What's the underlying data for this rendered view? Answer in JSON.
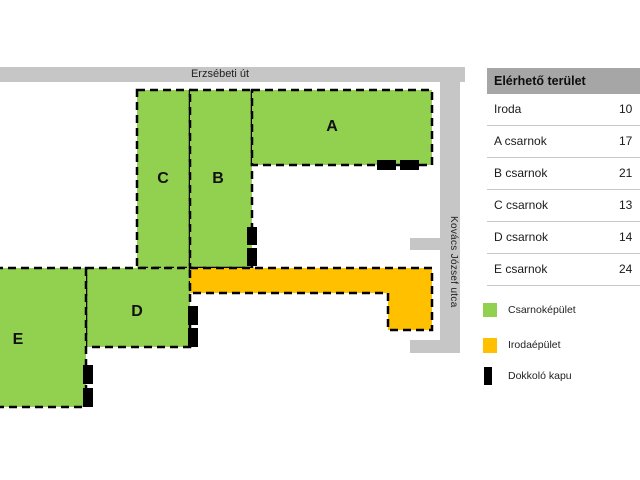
{
  "map": {
    "roads": {
      "top_label": "Erzsébeti út",
      "side_label": "Kovács József utca"
    },
    "buildings": [
      {
        "label": "A"
      },
      {
        "label": "B"
      },
      {
        "label": "C"
      },
      {
        "label": "D"
      },
      {
        "label": "E"
      }
    ]
  },
  "table": {
    "header": "Elérhető terület",
    "rows": [
      {
        "label": "Iroda",
        "value": "10"
      },
      {
        "label": "A csarnok",
        "value": "17"
      },
      {
        "label": "B csarnok",
        "value": "21"
      },
      {
        "label": "C csarnok",
        "value": "13"
      },
      {
        "label": "D csarnok",
        "value": "14"
      },
      {
        "label": "E csarnok",
        "value": "24"
      }
    ]
  },
  "legend": {
    "items": [
      {
        "label": "Csarnoképület"
      },
      {
        "label": "Irodaépület"
      },
      {
        "label": "Dokkoló kapu"
      }
    ]
  },
  "colors": {
    "hall_green": "#92D050",
    "office_orange": "#FFC000",
    "road_gray": "#C6C6C6",
    "table_header_gray": "#A6A6A6",
    "dock_black": "#000000"
  }
}
